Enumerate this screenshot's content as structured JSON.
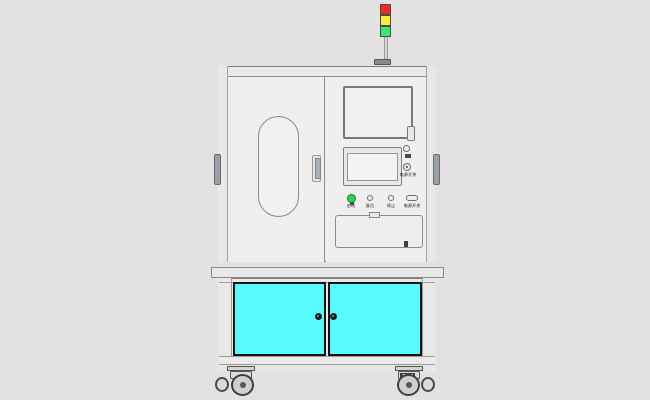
{
  "scene": {
    "background": "#e3e1e2",
    "subject": "industrial-test-machine-front-view"
  },
  "signal_tower": {
    "red": "#f12a1e",
    "yellow": "#f4ef33",
    "green": "#3fe473"
  },
  "machine": {
    "panel_color": "#efeeec",
    "outline_color": "#7d7d7d"
  },
  "control_panel": {
    "power_area_label": "电源开关",
    "buttons": [
      {
        "label": "启动",
        "color": "#2bd24d"
      },
      {
        "label": "复位",
        "color": "#f0efec"
      },
      {
        "label": "停止",
        "color": "#f0efec"
      },
      {
        "label": "电源开关",
        "color": "#f0efec"
      }
    ]
  },
  "lower_cabinet": {
    "door_color": "#58fbfd",
    "door_border": "#121212"
  }
}
